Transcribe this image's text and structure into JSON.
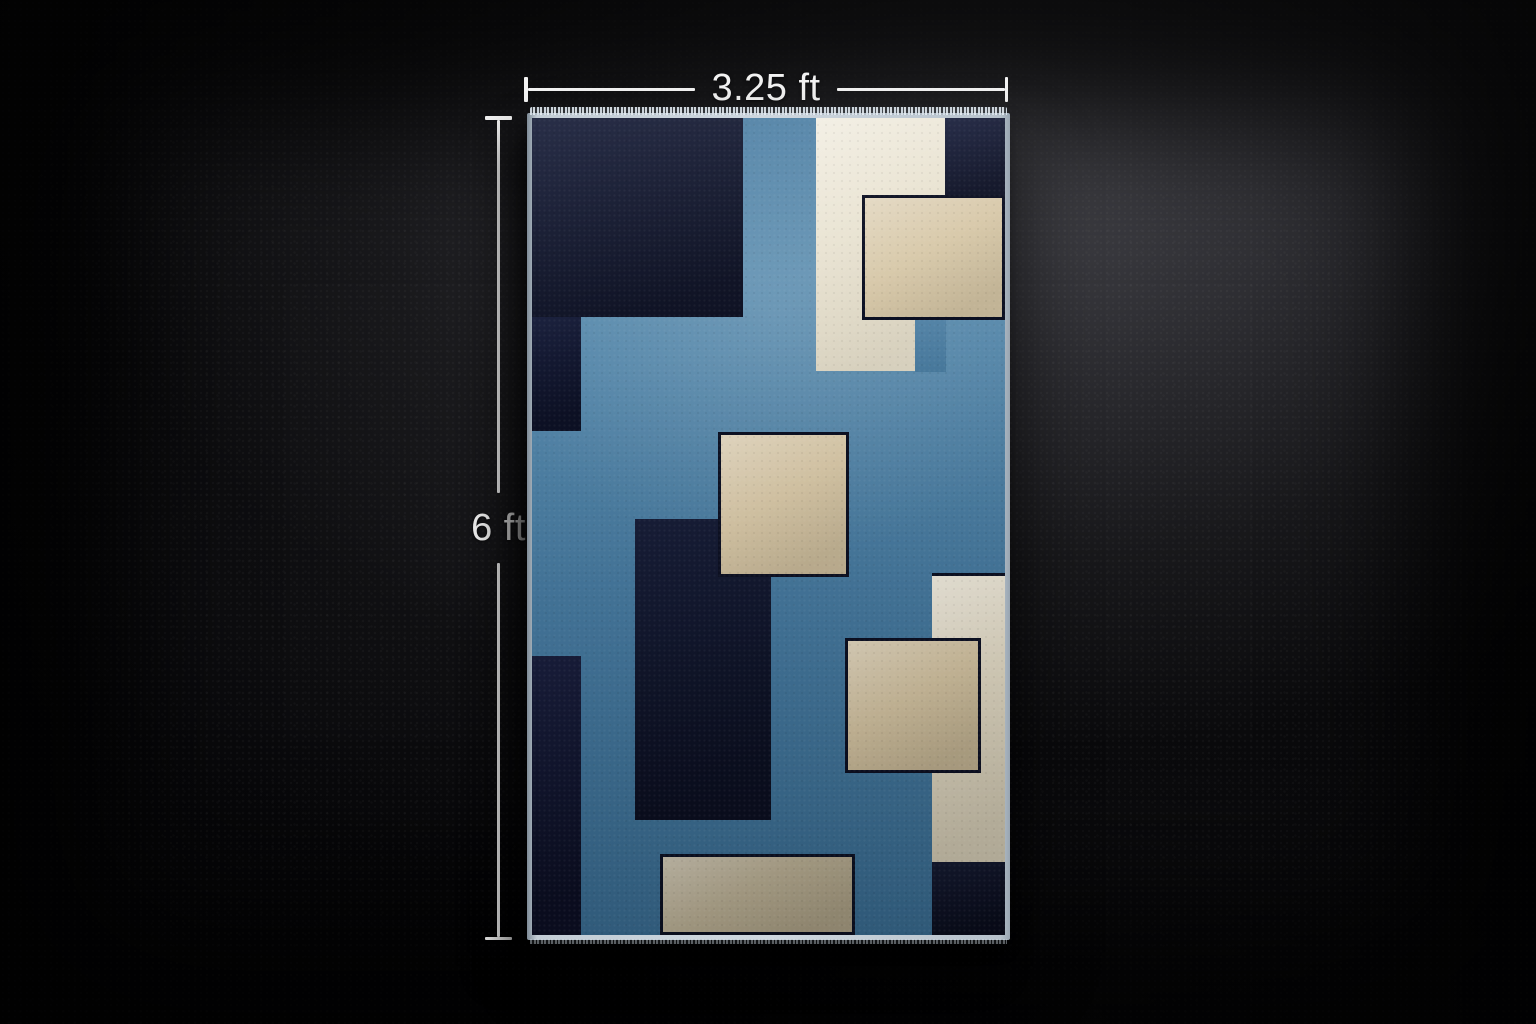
{
  "dimensions": {
    "width_label": "3.25 ft",
    "height_label": "6 ft",
    "line_color": "#f3f3f3"
  },
  "rug": {
    "binding_color": "#c3cdd6",
    "outline_color": "#0c1022",
    "field": {
      "top": "#4d7fa4",
      "upper": "#5a8cae",
      "lower": "#44769b",
      "bottom": "#386a8f"
    },
    "blocks": [
      {
        "name": "navy-top-left-block",
        "color": "#131831",
        "left": 0,
        "top": 0,
        "width": 44.6,
        "height": 24.4,
        "outline": "none",
        "finish": "navy"
      },
      {
        "name": "navy-left-upper-strip",
        "color": "#111631",
        "left": 0,
        "top": 24.3,
        "width": 10.4,
        "height": 14.0,
        "outline": "none",
        "finish": "navy"
      },
      {
        "name": "navy-left-lower-strip",
        "color": "#101430",
        "left": 0,
        "top": 65.8,
        "width": 10.4,
        "height": 34.2,
        "outline": "none",
        "finish": "navy"
      },
      {
        "name": "navy-center-block",
        "color": "#0f142c",
        "left": 21.7,
        "top": 49.1,
        "width": 28.8,
        "height": 36.8,
        "outline": "none",
        "finish": "navy"
      },
      {
        "name": "navy-top-right-block",
        "color": "#161b36",
        "left": 87.4,
        "top": 0,
        "width": 12.6,
        "height": 9.6,
        "outline": "none",
        "finish": "navy"
      },
      {
        "name": "navy-bottom-right-block",
        "color": "#0d1126",
        "left": 84.6,
        "top": 91.1,
        "width": 15.4,
        "height": 8.9,
        "outline": "none",
        "finish": "navy"
      },
      {
        "name": "cream-top-block",
        "color": "#eae4d3",
        "left": 60.1,
        "top": 0,
        "width": 27.3,
        "height": 31.0,
        "outline": "none",
        "finish": "cream"
      },
      {
        "name": "field-notch",
        "color": "#4a7da2",
        "left": 81.0,
        "top": 24.7,
        "width": 6.5,
        "height": 6.4,
        "outline": "none",
        "finish": "field"
      },
      {
        "name": "cream-right-column",
        "color": "#ddd5c0",
        "left": 84.6,
        "top": 55.7,
        "width": 15.4,
        "height": 35.4,
        "outline": "top",
        "finish": "cream"
      },
      {
        "name": "beige-top-right-block",
        "color": "#d8c9aa",
        "left": 69.7,
        "top": 9.4,
        "width": 30.3,
        "height": 15.3,
        "outline": "full",
        "finish": "beige"
      },
      {
        "name": "beige-center-square",
        "color": "#d5c5a5",
        "left": 39.4,
        "top": 38.4,
        "width": 27.7,
        "height": 17.8,
        "outline": "full",
        "finish": "beige"
      },
      {
        "name": "beige-right-block",
        "color": "#cfbf9e",
        "left": 66.1,
        "top": 63.7,
        "width": 28.8,
        "height": 16.5,
        "outline": "full",
        "finish": "beige"
      },
      {
        "name": "beige-bottom-rect",
        "color": "#b9ae93",
        "left": 27.1,
        "top": 90.1,
        "width": 41.2,
        "height": 9.9,
        "outline": "full",
        "finish": "beige"
      }
    ]
  }
}
